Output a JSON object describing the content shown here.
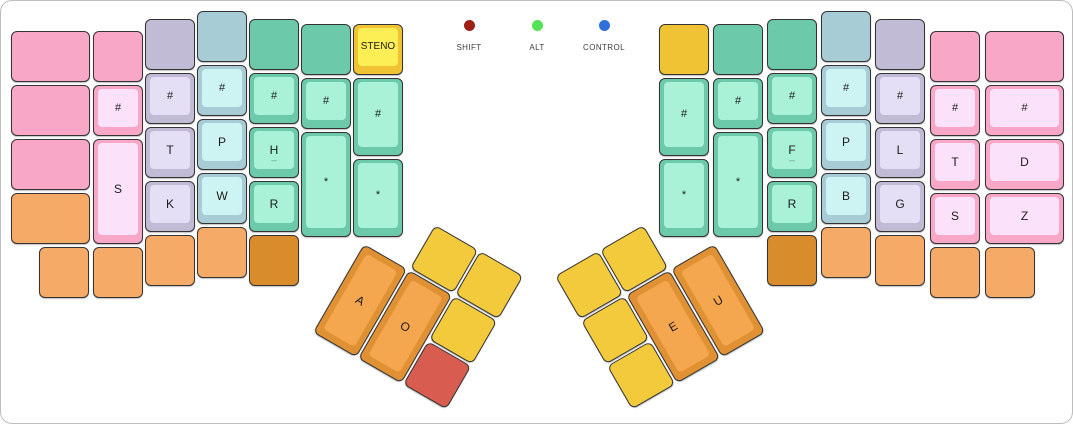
{
  "palette": {
    "pink": {
      "base": "#f9a7c6",
      "face": "#fbe2fa"
    },
    "lavender": {
      "base": "#c2bbd5",
      "face": "#e5dff5"
    },
    "blue": {
      "base": "#a8ccd5",
      "face": "#cdf4f2"
    },
    "teal": {
      "base": "#6cc9a9",
      "face": "#a9f2d8"
    },
    "orange": {
      "base": "#f6aa67",
      "face": "#f9c894"
    },
    "dkorange": {
      "base": "#d88c2b",
      "face": "#e8a94f"
    },
    "yellow": {
      "base": "#f0c334",
      "face": "#fcee55"
    },
    "tyellow": {
      "base": "#f3ca3b",
      "face": "#f8dc6a"
    },
    "red": {
      "base": "#d85d50",
      "face": "#e58177"
    },
    "torange": {
      "base": "#df9133",
      "face": "#f5a74f"
    }
  },
  "indicators": [
    {
      "label": "SHIFT",
      "color": "#9c2016",
      "center_x": 468
    },
    {
      "label": "ALT",
      "color": "#54e356",
      "center_x": 536
    },
    {
      "label": "CONTROL",
      "color": "#2f70da",
      "center_x": 603
    }
  ],
  "keyboard": {
    "left_main": [
      {
        "x": 10,
        "y": 30,
        "w": 79,
        "c": "pink"
      },
      {
        "x": 10,
        "y": 84,
        "w": 79,
        "c": "pink"
      },
      {
        "x": 10,
        "y": 138,
        "w": 79,
        "c": "pink"
      },
      {
        "x": 10,
        "y": 192,
        "w": 79,
        "c": "orange"
      },
      {
        "x": 92,
        "y": 30,
        "c": "pink"
      },
      {
        "x": 92,
        "y": 84,
        "c": "pink",
        "l": "#",
        "f": 1
      },
      {
        "x": 92,
        "y": 138,
        "h": 105,
        "c": "pink",
        "l": "S",
        "f": 1
      },
      {
        "x": 92,
        "y": 246,
        "c": "orange"
      },
      {
        "x": 38,
        "y": 246,
        "c": "orange"
      },
      {
        "x": 144,
        "y": 18,
        "c": "lavender"
      },
      {
        "x": 144,
        "y": 72,
        "c": "lavender",
        "l": "#",
        "f": 1
      },
      {
        "x": 144,
        "y": 126,
        "c": "lavender",
        "l": "T",
        "f": 1
      },
      {
        "x": 144,
        "y": 180,
        "c": "lavender",
        "l": "K",
        "f": 1
      },
      {
        "x": 144,
        "y": 234,
        "c": "orange"
      },
      {
        "x": 196,
        "y": 10,
        "c": "blue"
      },
      {
        "x": 196,
        "y": 64,
        "c": "blue",
        "l": "#",
        "f": 1
      },
      {
        "x": 196,
        "y": 118,
        "c": "blue",
        "l": "P",
        "f": 1
      },
      {
        "x": 196,
        "y": 172,
        "c": "blue",
        "l": "W",
        "f": 1
      },
      {
        "x": 196,
        "y": 226,
        "c": "orange"
      },
      {
        "x": 248,
        "y": 18,
        "c": "teal"
      },
      {
        "x": 248,
        "y": 72,
        "c": "teal",
        "l": "#",
        "f": 1
      },
      {
        "x": 248,
        "y": 126,
        "c": "teal",
        "l": "H",
        "f": 1,
        "s": "_"
      },
      {
        "x": 248,
        "y": 180,
        "c": "teal",
        "l": "R",
        "f": 1
      },
      {
        "x": 248,
        "y": 234,
        "c": "dkorange"
      },
      {
        "x": 300,
        "y": 23,
        "c": "teal"
      },
      {
        "x": 300,
        "y": 77,
        "c": "teal",
        "l": "#",
        "f": 1
      },
      {
        "x": 300,
        "y": 131,
        "h": 105,
        "c": "teal",
        "l": "*",
        "f": 1
      },
      {
        "x": 352,
        "y": 23,
        "c": "yellow",
        "l": "STENO",
        "f": 1
      },
      {
        "x": 352,
        "y": 77,
        "h": 78,
        "c": "teal",
        "l": "#",
        "f": 1
      },
      {
        "x": 352,
        "y": 158,
        "h": 78,
        "c": "teal",
        "l": "*",
        "f": 1
      }
    ],
    "right_main": [
      {
        "x": 658,
        "y": 23,
        "c": "yellow"
      },
      {
        "x": 658,
        "y": 77,
        "h": 78,
        "c": "teal",
        "l": "#",
        "f": 1
      },
      {
        "x": 658,
        "y": 158,
        "h": 78,
        "c": "teal",
        "l": "*",
        "f": 1
      },
      {
        "x": 712,
        "y": 23,
        "c": "teal"
      },
      {
        "x": 712,
        "y": 77,
        "c": "teal",
        "l": "#",
        "f": 1
      },
      {
        "x": 712,
        "y": 131,
        "h": 105,
        "c": "teal",
        "l": "*",
        "f": 1
      },
      {
        "x": 766,
        "y": 18,
        "c": "teal"
      },
      {
        "x": 766,
        "y": 72,
        "c": "teal",
        "l": "#",
        "f": 1
      },
      {
        "x": 766,
        "y": 126,
        "c": "teal",
        "l": "F",
        "f": 1,
        "s": "_"
      },
      {
        "x": 766,
        "y": 180,
        "c": "teal",
        "l": "R",
        "f": 1
      },
      {
        "x": 766,
        "y": 234,
        "c": "dkorange"
      },
      {
        "x": 820,
        "y": 10,
        "c": "blue"
      },
      {
        "x": 820,
        "y": 64,
        "c": "blue",
        "l": "#",
        "f": 1
      },
      {
        "x": 820,
        "y": 118,
        "c": "blue",
        "l": "P",
        "f": 1
      },
      {
        "x": 820,
        "y": 172,
        "c": "blue",
        "l": "B",
        "f": 1
      },
      {
        "x": 820,
        "y": 226,
        "c": "orange"
      },
      {
        "x": 874,
        "y": 18,
        "c": "lavender"
      },
      {
        "x": 874,
        "y": 72,
        "c": "lavender",
        "l": "#",
        "f": 1
      },
      {
        "x": 874,
        "y": 126,
        "c": "lavender",
        "l": "L",
        "f": 1
      },
      {
        "x": 874,
        "y": 180,
        "c": "lavender",
        "l": "G",
        "f": 1
      },
      {
        "x": 874,
        "y": 234,
        "c": "orange"
      },
      {
        "x": 929,
        "y": 30,
        "c": "pink"
      },
      {
        "x": 929,
        "y": 84,
        "c": "pink",
        "l": "#",
        "f": 1
      },
      {
        "x": 929,
        "y": 138,
        "c": "pink",
        "l": "T",
        "f": 1
      },
      {
        "x": 929,
        "y": 192,
        "c": "pink",
        "l": "S",
        "f": 1
      },
      {
        "x": 929,
        "y": 246,
        "c": "orange"
      },
      {
        "x": 984,
        "y": 30,
        "w": 79,
        "c": "pink"
      },
      {
        "x": 984,
        "y": 84,
        "w": 79,
        "c": "pink",
        "l": "#",
        "f": 1
      },
      {
        "x": 984,
        "y": 138,
        "w": 79,
        "c": "pink",
        "l": "D",
        "f": 1
      },
      {
        "x": 984,
        "y": 192,
        "w": 79,
        "c": "pink",
        "l": "Z",
        "f": 1
      },
      {
        "x": 984,
        "y": 246,
        "c": "orange"
      }
    ],
    "left_thumb": {
      "origin_x": 389,
      "origin_y": 198,
      "angle_deg": 30,
      "keys": [
        {
          "x": 52,
          "y": 0,
          "h": 50,
          "c": "tyellow"
        },
        {
          "x": 104,
          "y": 0,
          "h": 50,
          "c": "tyellow"
        },
        {
          "x": 0,
          "y": 52,
          "h": 102,
          "c": "torange",
          "l": "A",
          "f": 1,
          "rim": 1
        },
        {
          "x": 52,
          "y": 52,
          "h": 102,
          "c": "torange",
          "l": "O",
          "f": 1,
          "rim": 1
        },
        {
          "x": 104,
          "y": 52,
          "h": 50,
          "c": "tyellow"
        },
        {
          "x": 104,
          "y": 104,
          "h": 50,
          "c": "red"
        }
      ]
    },
    "right_thumb": {
      "origin_x": 554,
      "origin_y": 275,
      "angle_deg": -30,
      "keys": [
        {
          "x": 0,
          "y": 0,
          "h": 50,
          "c": "tyellow"
        },
        {
          "x": 52,
          "y": 0,
          "h": 50,
          "c": "tyellow"
        },
        {
          "x": 0,
          "y": 52,
          "h": 50,
          "c": "tyellow"
        },
        {
          "x": 0,
          "y": 104,
          "h": 50,
          "c": "tyellow"
        },
        {
          "x": 52,
          "y": 52,
          "h": 102,
          "c": "torange",
          "l": "E",
          "f": 1,
          "rim": 1
        },
        {
          "x": 104,
          "y": 52,
          "h": 102,
          "c": "torange",
          "l": "U",
          "f": 1,
          "rim": 1
        }
      ]
    }
  }
}
